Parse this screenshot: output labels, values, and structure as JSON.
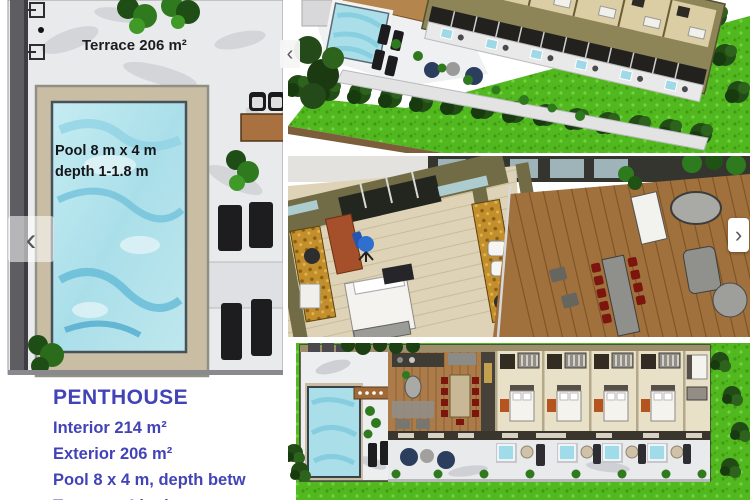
{
  "floorplan_panel": {
    "terrace_label": "Terrace 206 m²",
    "pool_label": {
      "line1": "Pool 8 m x 4 m",
      "line2": "depth 1-1.8 m"
    },
    "specs": {
      "title": "PENTHOUSE",
      "lines": [
        "Interior 214 m²",
        "Exterior 206 m²",
        "Pool 8 x 4 m, depth betw",
        "Terrace +4 bathrooms +"
      ]
    }
  },
  "carousel": {
    "prev_icon": "‹",
    "next_icon": "›"
  },
  "colors": {
    "spec_text": "#4343b8",
    "plan_text": "#1b1b1b",
    "pool_water": "#bfe7ee",
    "water_streak": "#63b9d6",
    "lawn_green": "#52b81f",
    "tree_green": "#224c16",
    "marble": "#ebecee",
    "deck_tan": "#c9bda4",
    "building_wall": "#8d8458",
    "interior_wall_olive": "#716c46",
    "wood_deck": "#a0703d",
    "bedroom_floor": "#e9e0c8",
    "chair_red": "#7c150e",
    "pouf_navy": "#2c3e5e",
    "counter_gold": "#c28f2c"
  }
}
